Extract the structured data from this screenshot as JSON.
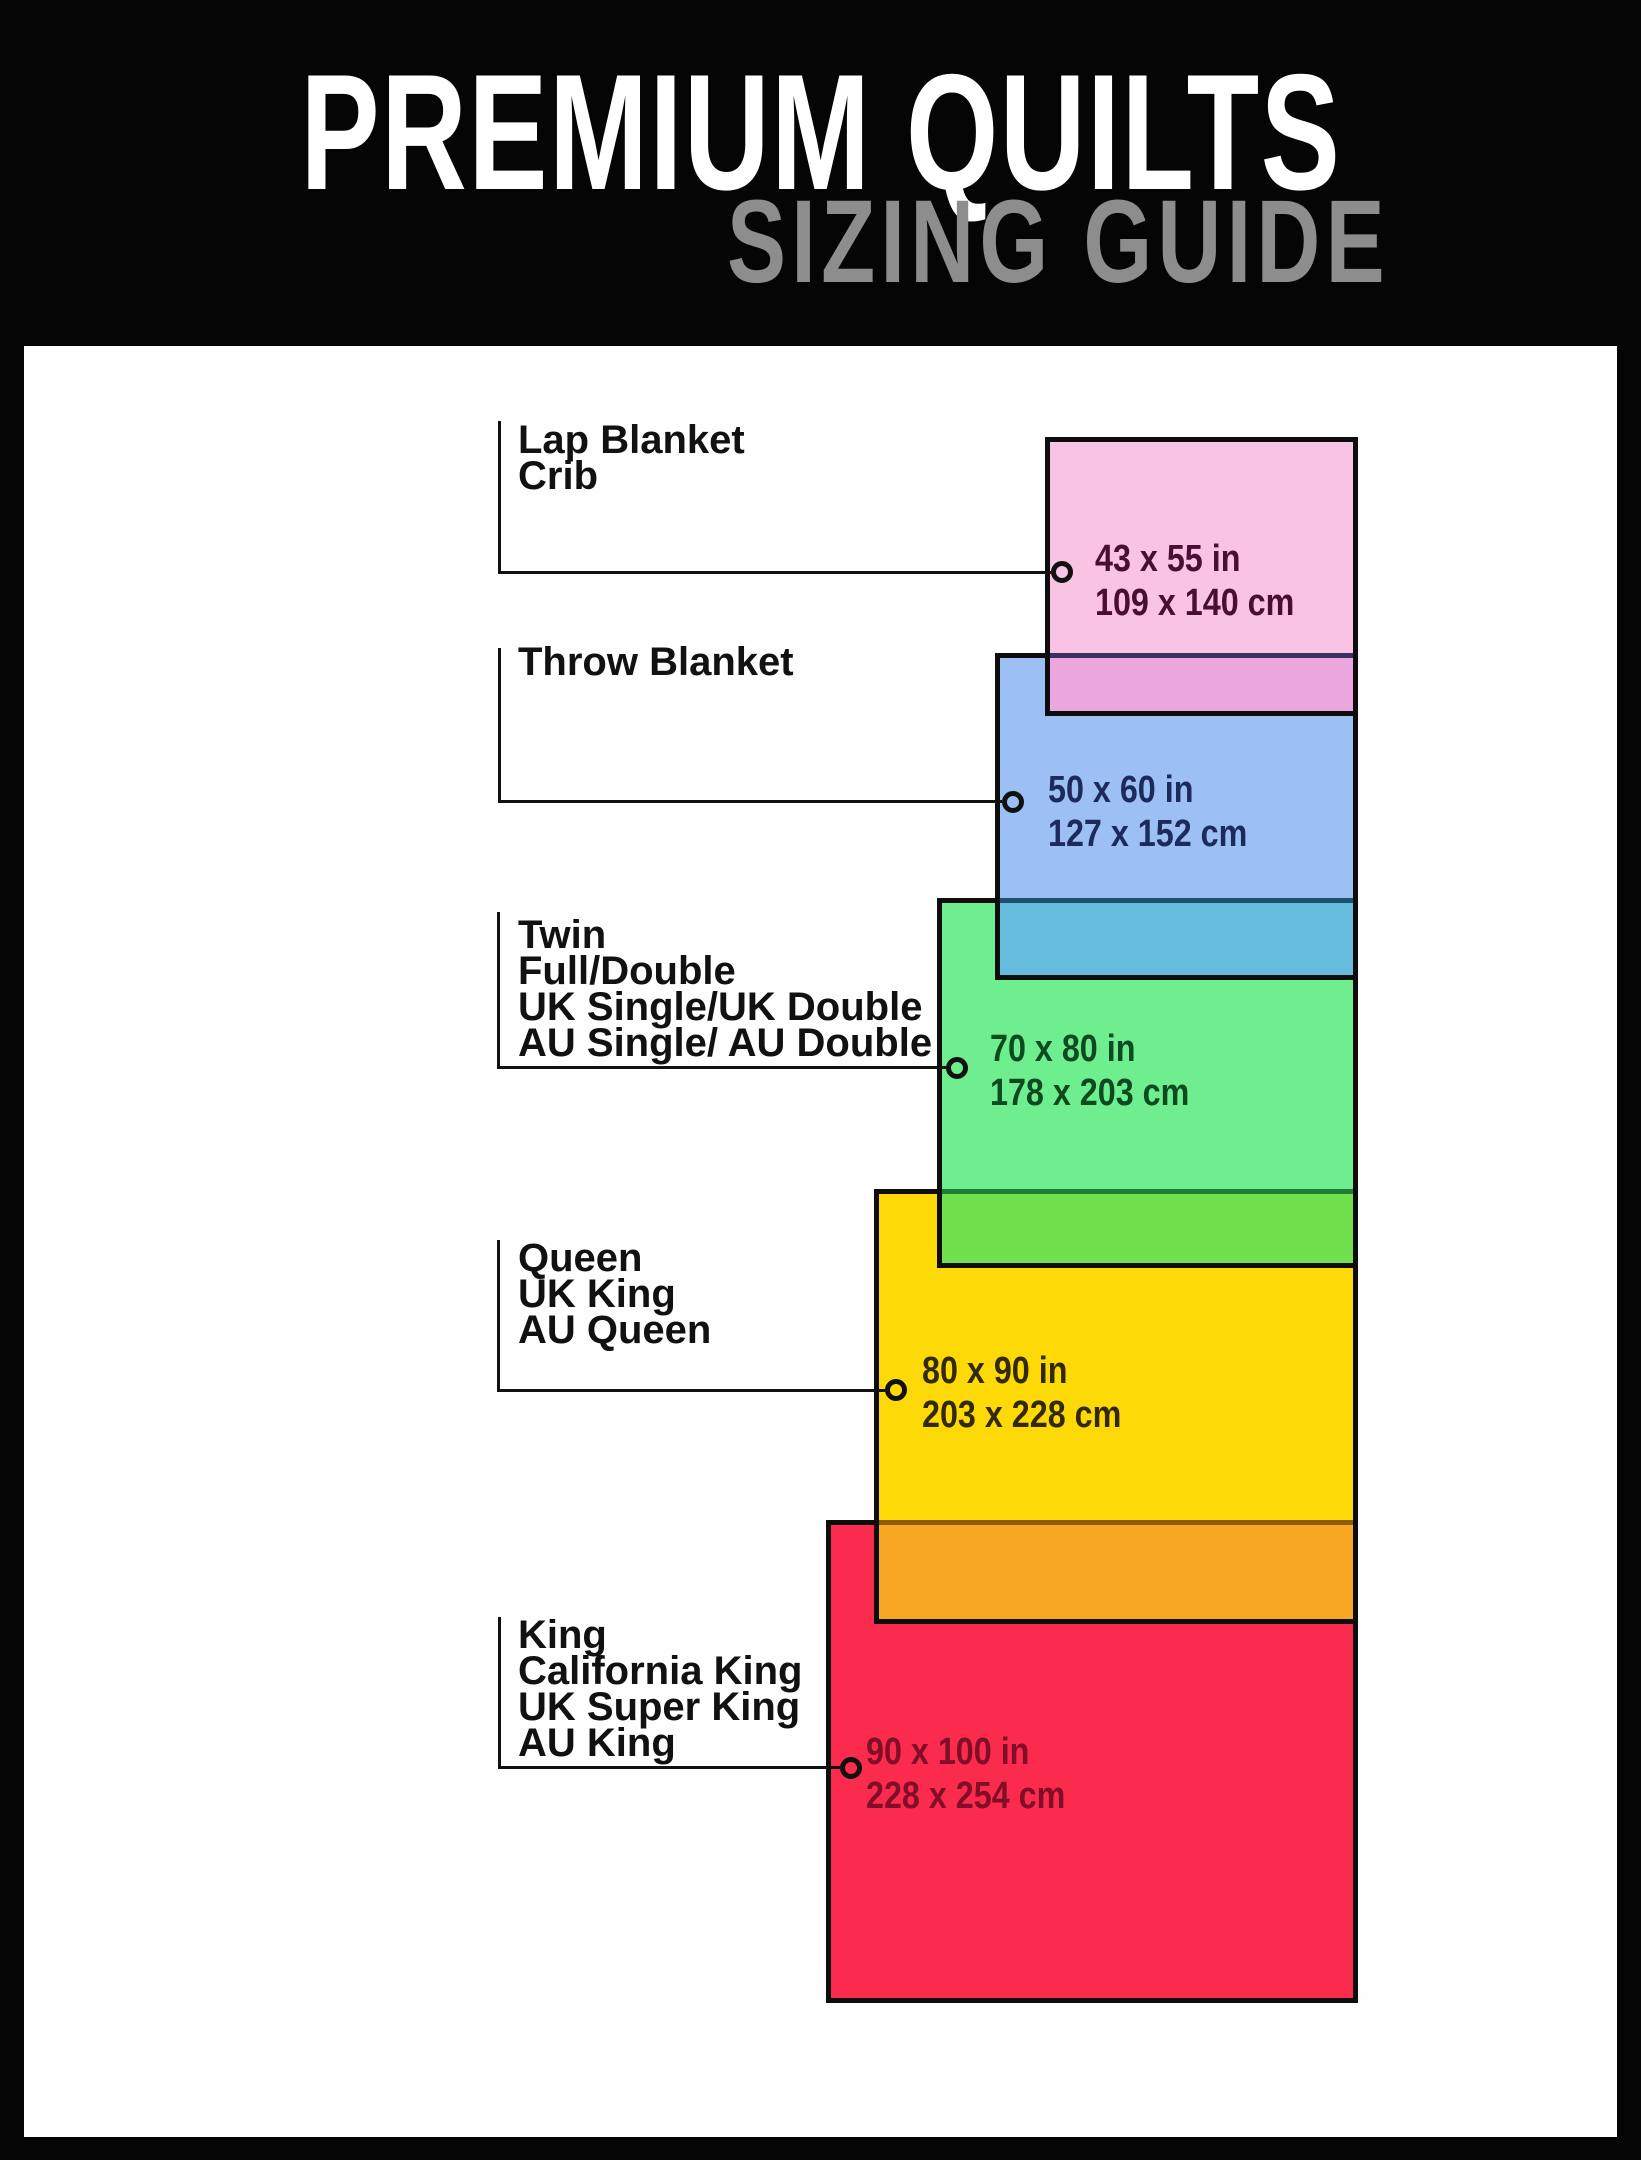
{
  "header": {
    "title": "PREMIUM QUILTS",
    "subtitle": "SIZING GUIDE",
    "background": "#050505",
    "title_color": "#ffffff",
    "subtitle_color": "#8d8d8d"
  },
  "panel": {
    "background": "#fefefe"
  },
  "sizes": [
    {
      "id": "lap-blanket",
      "labels": [
        "Lap Blanket",
        "Crib"
      ],
      "inches": "43 x 55 in",
      "cm": "109 x 140 cm",
      "fill": "#f9c3e4",
      "text_color": "#4a0d33"
    },
    {
      "id": "throw-blanket",
      "labels": [
        "Throw Blanket"
      ],
      "inches": "50 x 60 in",
      "cm": "127 x 152 cm",
      "fill": "#9cc0f4",
      "text_color": "#1c2a5c"
    },
    {
      "id": "twin",
      "labels": [
        "Twin",
        "Full/Double",
        "UK Single/UK Double",
        "AU Single/ AU Double"
      ],
      "inches": "70 x 80 in",
      "cm": "178 x 203 cm",
      "fill": "#6fee8f",
      "text_color": "#0d4a20"
    },
    {
      "id": "queen",
      "labels": [
        "Queen",
        "UK King",
        "AU Queen"
      ],
      "inches": "80 x 90 in",
      "cm": "203 x 228 cm",
      "fill": "#fed908",
      "text_color": "#332a05"
    },
    {
      "id": "king",
      "labels": [
        "King",
        "California King",
        "UK Super King",
        "AU King"
      ],
      "inches": "90 x 100 in",
      "cm": "228 x 254 cm",
      "fill": "#fb2b4e",
      "text_color": "#800e27"
    }
  ],
  "overlaps": [
    {
      "between": "lap-blanket/throw-blanket",
      "fill": "#eba6de",
      "divider": "#3a3160"
    },
    {
      "between": "throw-blanket/twin",
      "fill": "#66bcdc",
      "divider": "#1d4f6e"
    },
    {
      "between": "twin/queen",
      "fill": "#70e14d",
      "divider": "#1e7e33"
    },
    {
      "between": "queen/king",
      "fill": "#f7a723",
      "divider": "#8f5b04"
    }
  ],
  "line_color": "#111111"
}
